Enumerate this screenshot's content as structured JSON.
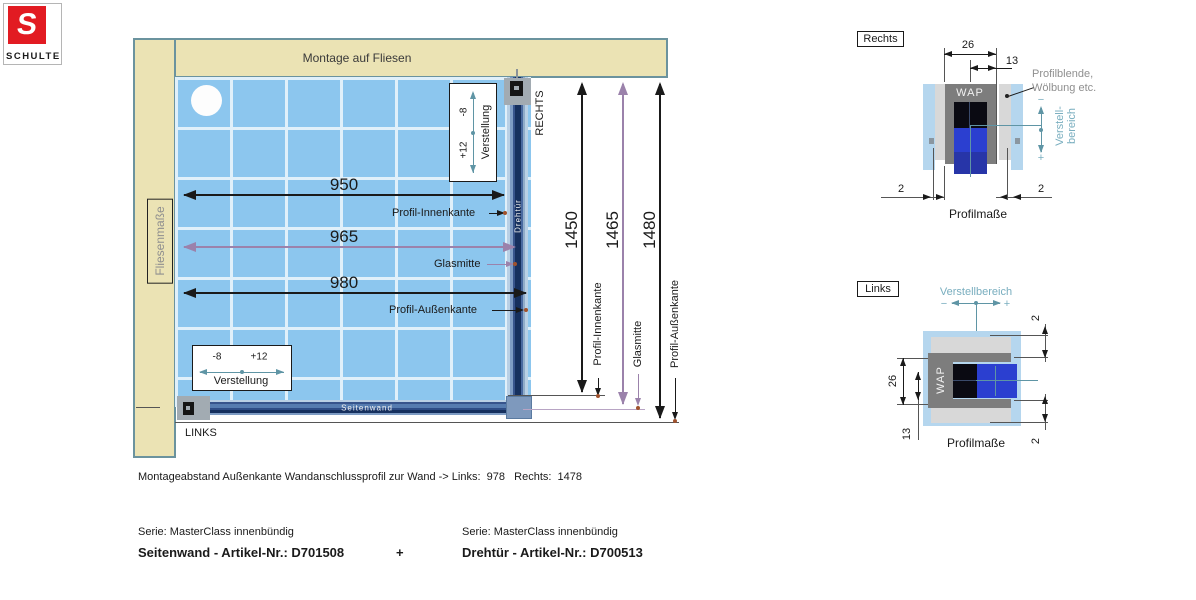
{
  "logo": {
    "letter": "S",
    "brand": "SCHULTE"
  },
  "main": {
    "header": "Montage auf Fliesen",
    "tile_label": "Fliesenmaße",
    "door_label": "Drehtür",
    "panel_label": "Seitenwand",
    "right_label": "RECHTS",
    "left_label": "LINKS",
    "width_dims": [
      {
        "value": "950",
        "label": "Profil-Innenkante"
      },
      {
        "value": "965",
        "label": "Glasmitte"
      },
      {
        "value": "980",
        "label": "Profil-Außenkante"
      }
    ],
    "height_dims": [
      {
        "value": "1450",
        "label": "Profil-Innenkante"
      },
      {
        "value": "1465",
        "label": "Glasmitte"
      },
      {
        "value": "1480",
        "label": "Profil-Außenkante"
      }
    ],
    "adjust_top": {
      "minus": "-8",
      "plus": "+12",
      "label": "Verstellung"
    },
    "adjust_bottom": {
      "minus": "-8",
      "plus": "+12",
      "label": "Verstellung"
    }
  },
  "detail_rechts": {
    "title": "Rechts",
    "dim_width": "26",
    "dim_half": "13",
    "dim_gap_left": "2",
    "dim_gap_right": "2",
    "wap": "WAP",
    "note_line1": "Profilblende,",
    "note_line2": "Wölbung etc.",
    "range_line1": "Verstell-",
    "range_line2": "bereich",
    "minus": "−",
    "plus": "+",
    "caption": "Profilmaße"
  },
  "detail_links": {
    "title": "Links",
    "range_label": "Verstellbereich",
    "minus": "−",
    "plus": "+",
    "dim_width": "26",
    "dim_half": "13",
    "dim_gap_top": "2",
    "dim_gap_bottom": "2",
    "wap": "WAP",
    "caption": "Profilmaße"
  },
  "footer": {
    "note": "Montageabstand Außenkante Wandanschlussprofil zur Wand -> Links:  978   Rechts:  1478",
    "series_left": "Serie: MasterClass innenbündig",
    "article_left": "Seitenwand - Artikel-Nr.: D701508",
    "plus": "+",
    "series_right": "Serie: MasterClass innenbündig",
    "article_right": "Drehtür - Artikel-Nr.: D700513"
  },
  "colors": {
    "accent_red": "#e21b22",
    "wall_beige": "#ebe3b4",
    "tile_blue": "#8cc6ee",
    "profile_navy": "#16305e",
    "dim_purple": "#9b82ab",
    "adjust_teal": "#5f95a5",
    "detail_light_blue": "#b5d6ee",
    "glass_blue": "#2b3fd0"
  }
}
